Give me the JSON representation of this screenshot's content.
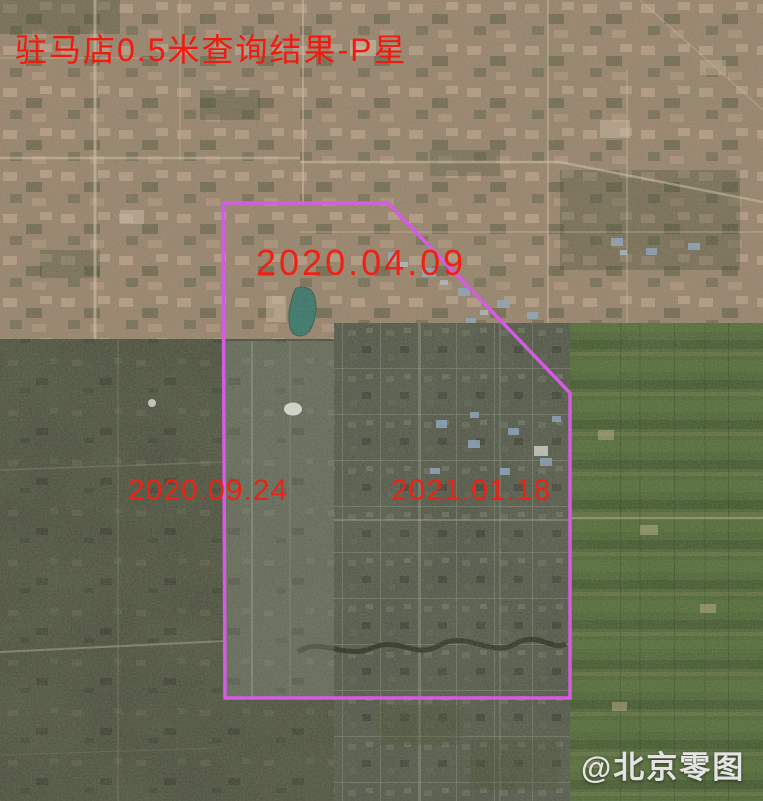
{
  "page": {
    "title": "驻马店0.5米查询结果-P星",
    "description_note": "satellite imagery query result mosaic"
  },
  "tiles": [
    {
      "name": "tile-2020-04-09",
      "date_label": "2020.04.09",
      "position": "top"
    },
    {
      "name": "tile-2020-09-24",
      "date_label": "2020.09.24",
      "position": "bottom-left"
    },
    {
      "name": "tile-2021-01-18",
      "date_label": "2021.01.18",
      "position": "center"
    }
  ],
  "watermark": {
    "text": "@北京零图"
  },
  "colors": {
    "label_red": "#f21a0e",
    "query_polygon_magenta": "#d45ce2",
    "watermark_white": "#e4e4e4",
    "lake_teal": "#2f7268"
  }
}
